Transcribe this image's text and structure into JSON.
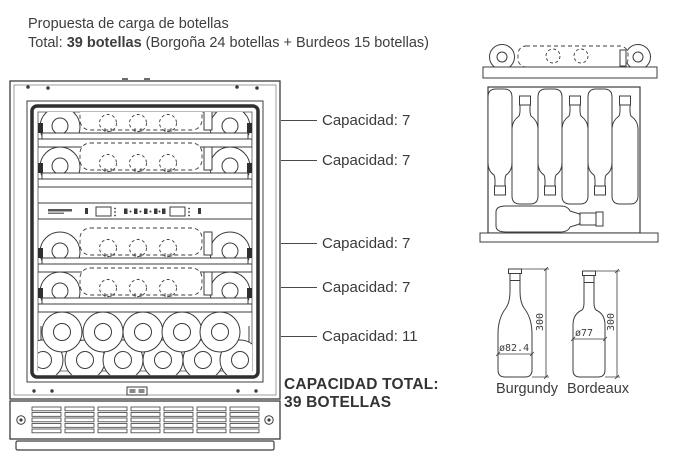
{
  "header": {
    "title": "Propuesta de carga de botellas",
    "total_prefix": "Total: ",
    "total_bold": "39 botellas",
    "total_suffix": " (Borgoña 24 botellas + Burdeos 15 botellas)"
  },
  "shelf_capacities": [
    {
      "label": "Capacidad: 7"
    },
    {
      "label": "Capacidad: 7"
    },
    {
      "label": "Capacidad: 7"
    },
    {
      "label": "Capacidad: 7"
    },
    {
      "label": "Capacidad: 11"
    }
  ],
  "total_capacity": {
    "line1": "CAPACIDAD TOTAL:",
    "line2": "39 BOTELLAS"
  },
  "bottle_types": [
    {
      "name": "Burgundy",
      "diameter": "ø82.4",
      "height": "300"
    },
    {
      "name": "Bordeaux",
      "diameter": "ø77",
      "height": "300"
    }
  ],
  "diagram": {
    "shelves": 5,
    "bottles_per_shelf": [
      7,
      7,
      7,
      7,
      11
    ],
    "total_bottles": 39
  },
  "colors": {
    "line": "#3c3c3c",
    "text": "#3e3e3e",
    "text_bold": "#333333"
  }
}
